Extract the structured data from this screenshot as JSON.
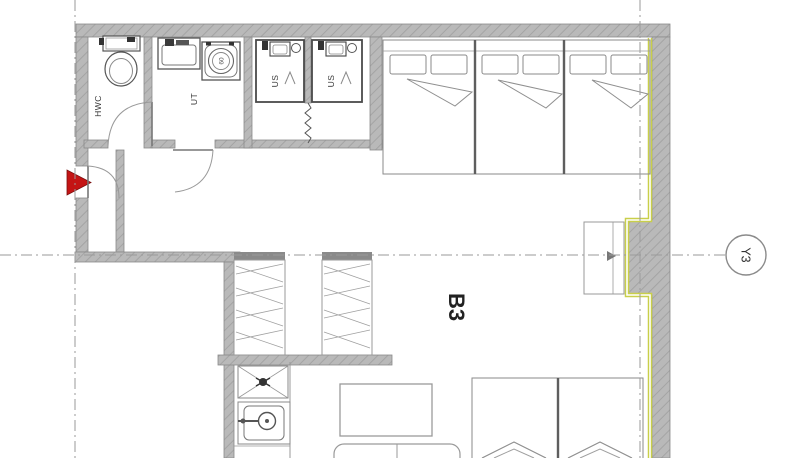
{
  "unit": {
    "label": "B3"
  },
  "grid": {
    "marker_label": "Y3"
  },
  "rooms": {
    "wc": {
      "label": "HWC"
    },
    "laundry": {
      "label": "UT"
    },
    "shower_1": {
      "label": "US"
    },
    "shower_2": {
      "label": "US"
    }
  },
  "fixtures": {
    "washing_machine_label": "60"
  },
  "furniture": {
    "beds_top": 3,
    "beds_bottom": 2,
    "wardrobes": 2,
    "shower_cabins": 2
  },
  "colors": {
    "wall_fill": "#b9b9b9",
    "wall_hatch": "#a4a4a4",
    "outline": "#8a8a8a",
    "dark_line": "#4a4a4a",
    "accent_red": "#c41414",
    "insulation_yellow": "#c9cf4a",
    "grid_line": "#9a9a9a",
    "text": "#333333"
  }
}
